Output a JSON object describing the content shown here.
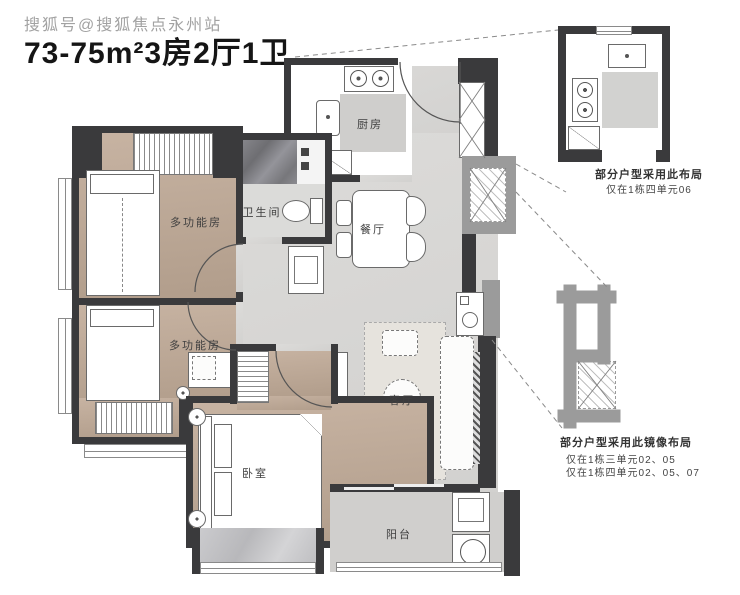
{
  "watermark": "搜狐号@搜狐焦点永州站",
  "title": "73-75m²3房2厅1卫",
  "plan": {
    "rooms": {
      "multi_function_1": "多功能房",
      "multi_function_2": "多功能房",
      "bathroom": "卫生间",
      "kitchen": "厨房",
      "dining": "餐厅",
      "living": "客厅",
      "bedroom": "卧室",
      "balcony": "阳台"
    },
    "colors": {
      "wall": "#3a3a3c",
      "wood_floor": "#bca892",
      "tile_floor": "#d7d6d4",
      "exterior_bump": "#9b9b9b"
    }
  },
  "insets": {
    "kitchen_variant": {
      "caption_line1": "部分户型采用此布局",
      "caption_line2": "仅在1栋四单元06"
    },
    "mirrored_variant": {
      "caption_line1": "部分户型采用此镜像布局",
      "caption_line2": "仅在1栋三单元02、05",
      "caption_line3": "仅在1栋四单元02、05、07"
    }
  }
}
